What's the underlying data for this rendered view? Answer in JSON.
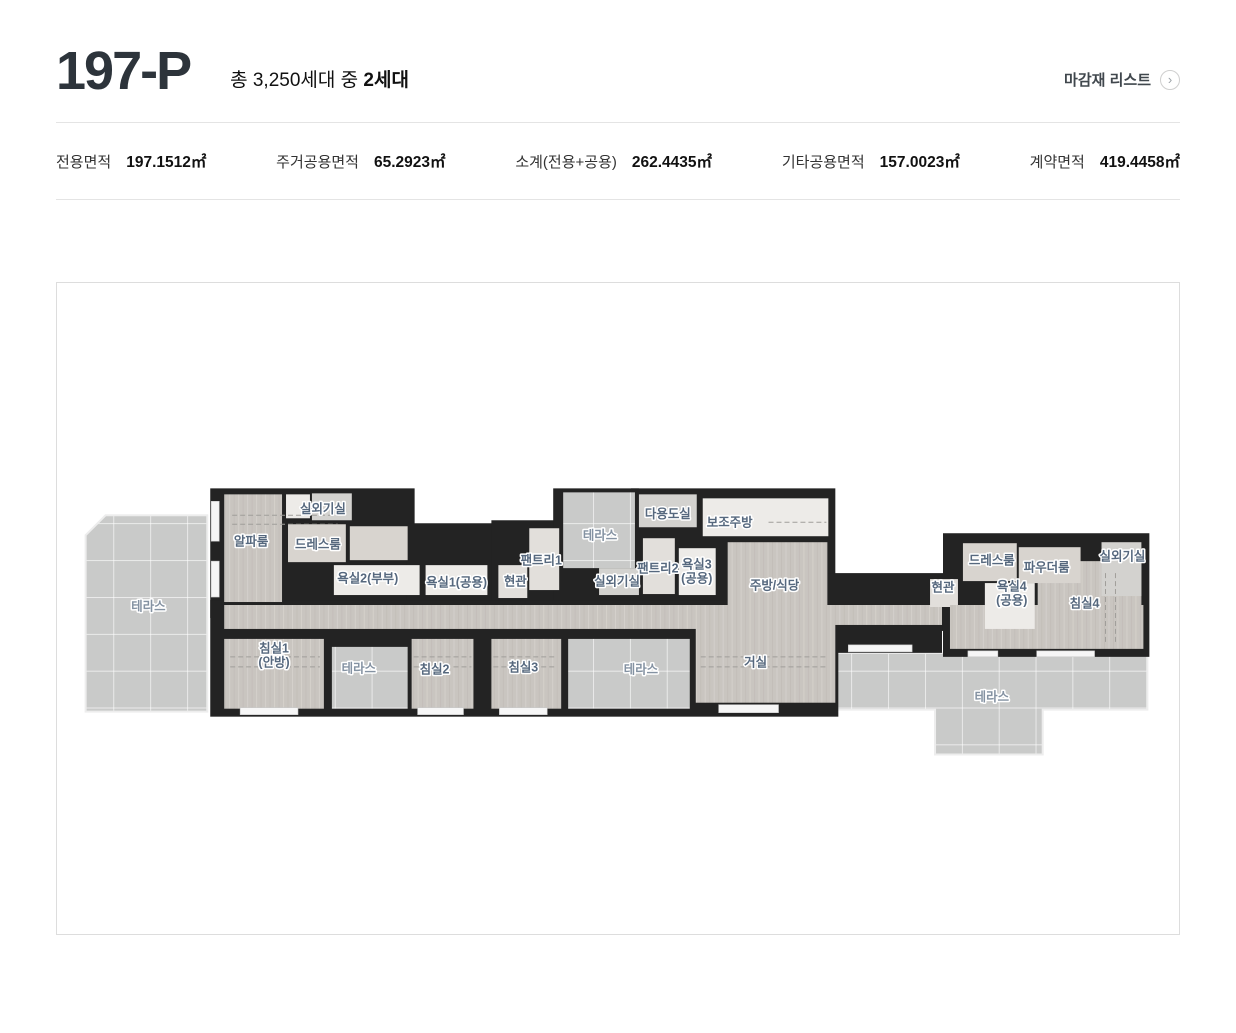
{
  "header": {
    "title": "197-P",
    "subtitle_prefix": "총 3,250세대 중 ",
    "subtitle_bold": "2세대",
    "finish_link": "마감재 리스트",
    "finish_link_icon": "chevron-right-circle"
  },
  "stats": [
    {
      "label": "전용면적",
      "value": "197.1512㎡"
    },
    {
      "label": "주거공용면적",
      "value": "65.2923㎡"
    },
    {
      "label": "소계(전용+공용)",
      "value": "262.4435㎡"
    },
    {
      "label": "기타공용면적",
      "value": "157.0023㎡"
    },
    {
      "label": "계약면적",
      "value": "419.4458㎡"
    }
  ],
  "floorplan": {
    "colors": {
      "wall": "#232323",
      "floor": "#c9c5c0",
      "light": "#d8d4cf",
      "tile": "#e2dfdb",
      "white": "#edebe8",
      "util": "#d3d2cf",
      "terrace": "#c9cac9",
      "dash": "#a09e9a",
      "label": "#56687e",
      "label_muted": "#8492a2"
    },
    "terraces": [
      {
        "name": "terrace-left",
        "points": "83,530 103,510 205,510 205,707 83,707"
      },
      {
        "name": "terrace-right",
        "points": "832,648 1148,648 1148,705 1043,705 1043,750 935,750 935,705 832,705"
      }
    ],
    "walls": [
      [
        208,
        483,
        205,
        130
      ],
      [
        405,
        518,
        95,
        95
      ],
      [
        490,
        515,
        85,
        115
      ],
      [
        552,
        483,
        86,
        120
      ],
      [
        630,
        483,
        205,
        145
      ],
      [
        208,
        595,
        630,
        117
      ],
      [
        820,
        568,
        128,
        58
      ],
      [
        943,
        528,
        207,
        124
      ],
      [
        822,
        618,
        120,
        30
      ]
    ],
    "rooms": [
      {
        "name": "room-alpha",
        "type": "floor",
        "r": [
          222,
          489,
          58,
          108
        ]
      },
      {
        "name": "closet-alpha",
        "type": "white",
        "r": [
          284,
          489,
          24,
          24
        ]
      },
      {
        "name": "room-outdoor-unit-left",
        "type": "util",
        "r": [
          310,
          488,
          40,
          27
        ]
      },
      {
        "name": "room-dress-left",
        "type": "light",
        "r": [
          286,
          519,
          58,
          38
        ]
      },
      {
        "name": "dress-left-ext",
        "type": "light",
        "r": [
          348,
          521,
          58,
          34
        ]
      },
      {
        "name": "room-bath2",
        "type": "white",
        "r": [
          332,
          560,
          86,
          30
        ]
      },
      {
        "name": "room-bath1",
        "type": "white",
        "r": [
          424,
          560,
          62,
          30
        ]
      },
      {
        "name": "room-entry-left",
        "type": "tile",
        "r": [
          497,
          560,
          29,
          33
        ]
      },
      {
        "name": "room-pantry1",
        "type": "tile",
        "r": [
          528,
          523,
          30,
          62
        ]
      },
      {
        "name": "terrace-top-mid",
        "type": "terrace",
        "r": [
          562,
          487,
          72,
          76
        ]
      },
      {
        "name": "room-outdoor-unit-mid",
        "type": "util",
        "r": [
          598,
          563,
          40,
          27
        ]
      },
      {
        "name": "room-pantry2",
        "type": "tile",
        "r": [
          642,
          533,
          32,
          56
        ]
      },
      {
        "name": "room-bath3",
        "type": "white",
        "r": [
          678,
          543,
          37,
          47
        ]
      },
      {
        "name": "room-multi",
        "type": "util",
        "r": [
          638,
          489,
          58,
          33
        ]
      },
      {
        "name": "room-aux-kitchen",
        "type": "white",
        "r": [
          702,
          493,
          126,
          38
        ]
      },
      {
        "name": "room-kitchen",
        "type": "floor",
        "r": [
          727,
          537,
          100,
          83
        ]
      },
      {
        "name": "corridor",
        "type": "floor",
        "r": [
          222,
          600,
          480,
          24
        ]
      },
      {
        "name": "corridor-right",
        "type": "floor",
        "r": [
          822,
          600,
          120,
          20
        ]
      },
      {
        "name": "room-living",
        "type": "floor",
        "r": [
          695,
          600,
          140,
          98
        ]
      },
      {
        "name": "room-bed1",
        "type": "floor",
        "r": [
          222,
          634,
          100,
          70
        ]
      },
      {
        "name": "terrace-small-1",
        "type": "terrace",
        "r": [
          330,
          642,
          76,
          62
        ]
      },
      {
        "name": "room-bed2",
        "type": "floor",
        "r": [
          410,
          634,
          62,
          70
        ]
      },
      {
        "name": "room-bed3",
        "type": "floor",
        "r": [
          490,
          634,
          70,
          70
        ]
      },
      {
        "name": "terrace-mid",
        "type": "terrace",
        "r": [
          567,
          634,
          122,
          70
        ]
      },
      {
        "name": "room-entry-right",
        "type": "tile",
        "r": [
          930,
          574,
          28,
          28
        ]
      },
      {
        "name": "rw-hall",
        "type": "floor",
        "r": [
          950,
          600,
          194,
          44
        ]
      },
      {
        "name": "room-bed4",
        "type": "floor",
        "r": [
          1038,
          556,
          104,
          86
        ]
      },
      {
        "name": "room-dress-right",
        "type": "light",
        "r": [
          963,
          538,
          54,
          38
        ]
      },
      {
        "name": "room-powder",
        "type": "light",
        "r": [
          1019,
          542,
          62,
          36
        ]
      },
      {
        "name": "room-outdoor-unit-right",
        "type": "util",
        "r": [
          1102,
          537,
          40,
          54
        ]
      },
      {
        "name": "room-bath4",
        "type": "white",
        "r": [
          985,
          578,
          50,
          46
        ]
      }
    ],
    "windows": [
      [
        238,
        703,
        58,
        7
      ],
      [
        416,
        703,
        46,
        7
      ],
      [
        498,
        703,
        48,
        7
      ],
      [
        718,
        700,
        60,
        8
      ],
      [
        209,
        496,
        8,
        40
      ],
      [
        209,
        556,
        8,
        36
      ],
      [
        848,
        640,
        64,
        7
      ],
      [
        968,
        646,
        30,
        6
      ],
      [
        1037,
        646,
        58,
        6
      ]
    ],
    "dashes": [
      [
        230,
        510,
        336,
        510
      ],
      [
        230,
        519,
        336,
        519
      ],
      [
        228,
        652,
        318,
        652
      ],
      [
        228,
        662,
        318,
        662
      ],
      [
        412,
        652,
        470,
        652
      ],
      [
        412,
        662,
        470,
        662
      ],
      [
        492,
        652,
        556,
        652
      ],
      [
        492,
        662,
        556,
        662
      ],
      [
        700,
        652,
        828,
        652
      ],
      [
        700,
        662,
        828,
        662
      ],
      [
        768,
        517,
        826,
        517
      ],
      [
        1106,
        568,
        1106,
        640
      ],
      [
        1116,
        568,
        1116,
        640
      ]
    ],
    "labels": [
      {
        "x": 146,
        "y": 601,
        "lines": [
          "테라스"
        ],
        "muted": true
      },
      {
        "x": 321,
        "y": 503,
        "lines": [
          "실외기실"
        ]
      },
      {
        "x": 249,
        "y": 536,
        "lines": [
          "알파룸"
        ]
      },
      {
        "x": 316,
        "y": 539,
        "lines": [
          "드레스룸"
        ]
      },
      {
        "x": 366,
        "y": 573,
        "lines": [
          "욕실2(부부)"
        ]
      },
      {
        "x": 455,
        "y": 577,
        "lines": [
          "욕실1(공용)"
        ]
      },
      {
        "x": 514,
        "y": 576,
        "lines": [
          "현관"
        ]
      },
      {
        "x": 540,
        "y": 555,
        "lines": [
          "팬트리1"
        ]
      },
      {
        "x": 599,
        "y": 530,
        "lines": [
          "테라스"
        ],
        "muted": true
      },
      {
        "x": 616,
        "y": 576,
        "lines": [
          "실외기실"
        ]
      },
      {
        "x": 657,
        "y": 563,
        "lines": [
          "팬트리2"
        ]
      },
      {
        "x": 696,
        "y": 566,
        "lines": [
          "욕실3",
          "(공용)"
        ]
      },
      {
        "x": 667,
        "y": 508,
        "lines": [
          "다용도실"
        ]
      },
      {
        "x": 729,
        "y": 517,
        "lines": [
          "보조주방"
        ]
      },
      {
        "x": 774,
        "y": 580,
        "lines": [
          "주방/식당"
        ]
      },
      {
        "x": 943,
        "y": 582,
        "lines": [
          "현관"
        ]
      },
      {
        "x": 992,
        "y": 555,
        "lines": [
          "드레스룸"
        ]
      },
      {
        "x": 1047,
        "y": 562,
        "lines": [
          "파우더룸"
        ]
      },
      {
        "x": 1123,
        "y": 551,
        "lines": [
          "실외기실"
        ]
      },
      {
        "x": 1012,
        "y": 588,
        "lines": [
          "욕실4",
          "(공용)"
        ]
      },
      {
        "x": 1085,
        "y": 598,
        "lines": [
          "침실4"
        ]
      },
      {
        "x": 272,
        "y": 650,
        "lines": [
          "침실1",
          "(안방)"
        ]
      },
      {
        "x": 357,
        "y": 663,
        "lines": [
          "테라스"
        ],
        "muted": true
      },
      {
        "x": 433,
        "y": 664,
        "lines": [
          "침실2"
        ]
      },
      {
        "x": 522,
        "y": 662,
        "lines": [
          "침실3"
        ]
      },
      {
        "x": 640,
        "y": 664,
        "lines": [
          "테라스"
        ],
        "muted": true
      },
      {
        "x": 755,
        "y": 657,
        "lines": [
          "거실"
        ]
      },
      {
        "x": 992,
        "y": 692,
        "lines": [
          "테라스"
        ],
        "muted": true
      }
    ]
  }
}
